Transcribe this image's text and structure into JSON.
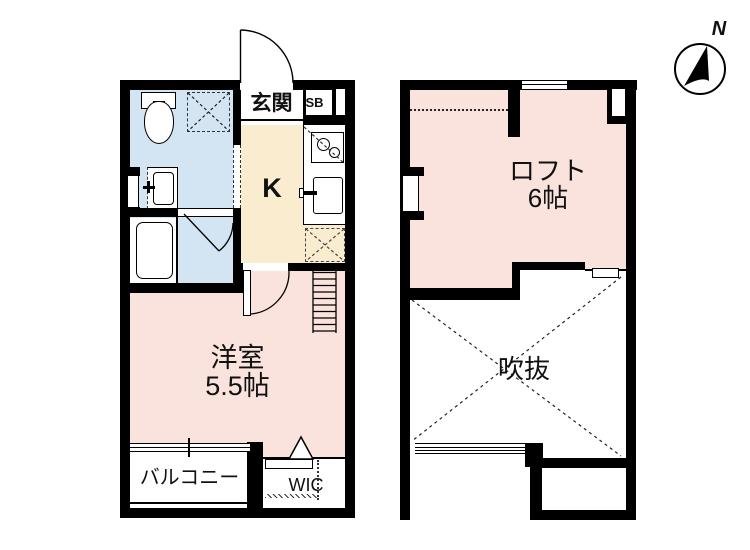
{
  "compass": {
    "label": "N"
  },
  "floor1": {
    "entrance_label": "玄関",
    "shoebox_label": "SB",
    "kitchen_label": "K",
    "room_label": "洋室",
    "room_size": "5.5帖",
    "balcony_label": "バルコニー",
    "wic_label": "WIC"
  },
  "floor2": {
    "loft_label": "ロフト",
    "loft_size": "6帖",
    "void_label": "吹抜"
  },
  "colors": {
    "room_pink": "#fae3dc",
    "wet_blue": "#d3e5f2",
    "kitchen_cream": "#faeccf",
    "wall": "#000000",
    "background": "#ffffff"
  }
}
